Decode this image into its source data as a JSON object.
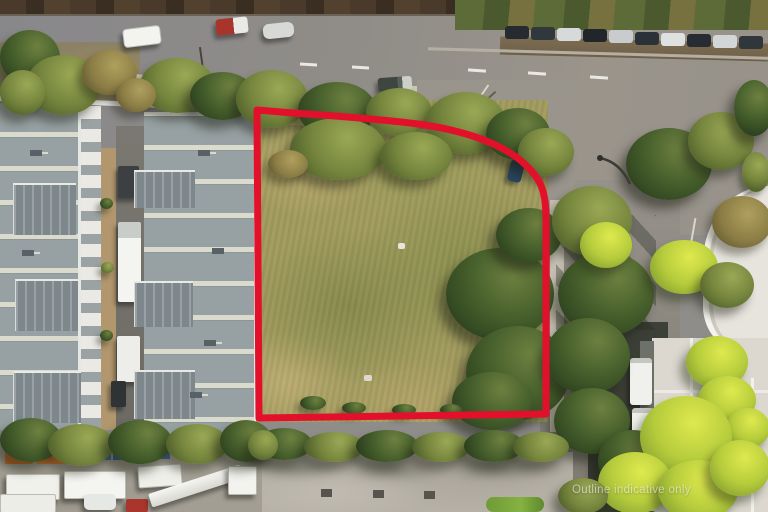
{
  "meta": {
    "type": "aerial-drone-photograph",
    "subject": "vacant land parcel outlined in red within an industrial estate",
    "width_px": 768,
    "height_px": 512
  },
  "watermark": {
    "text": "Outline indicative only"
  },
  "colors": {
    "outline": "#e3102b",
    "road": "#8f8d8a",
    "intersection": "#99948c",
    "grass_base": "#a09a5e",
    "roof_gray": "#97a0a2",
    "roof_annex": "#7d878c",
    "concrete": "#b6b1a7",
    "footpath": "#cbc5b8",
    "shadow_road": "#33382f",
    "tree_dark": "#3a5226",
    "tree_lime": "#c3d549",
    "median_brown": "#43362b"
  },
  "scene": {
    "parcel_label": "red-outlined vacant grass lot",
    "left_area": "industrial warehouse roofs with skylight strips and service alley",
    "top_area": "main road with passing vehicles and parked car row",
    "right_area": "side street with parked white vans, trees and white commercial buildings",
    "bottom_area": "concrete apron with hedge row and truck depot yard"
  }
}
